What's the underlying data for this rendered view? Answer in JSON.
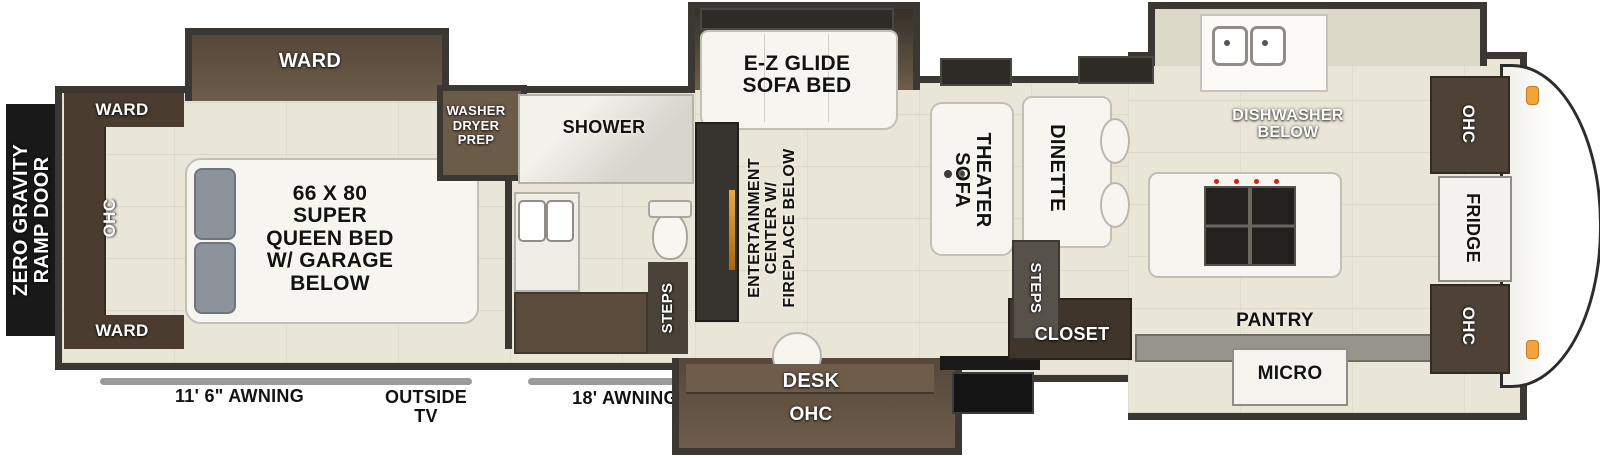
{
  "ramp_door": {
    "label": "ZERO GRAVITY RAMP DOOR"
  },
  "bedroom": {
    "slide_ward_label": "WARD",
    "corner_ward_label": "WARD",
    "bottom_ward_label": "WARD",
    "ohc_label": "OHC",
    "bed_label": "66 X 80 SUPER QUEEN BED W/ GARAGE BELOW"
  },
  "bath": {
    "washer_dryer_label": "WASHER DRYER PREP",
    "shower_label": "SHOWER",
    "steps_label": "STEPS"
  },
  "living": {
    "sofa_bed_label": "E-Z GLIDE SOFA BED",
    "entertainment_label": "ENTERTAINMENT CENTER W/ FIREPLACE BELOW",
    "theater_sofa_label": "THEATER SOFA",
    "dinette_label": "DINETTE",
    "desk_label": "DESK",
    "desk_ohc_label": "OHC",
    "steps_label": "STEPS",
    "closet_label": "CLOSET"
  },
  "kitchen": {
    "dishwasher_label": "DISHWASHER BELOW",
    "pantry_label": "PANTRY",
    "micro_label": "MICRO",
    "ohc_top_label": "OHC",
    "fridge_label": "FRIDGE",
    "ohc_bottom_label": "OHC"
  },
  "exterior": {
    "awning_left_label": "11' 6\" AWNING",
    "outside_tv_label": "OUTSIDE TV",
    "awning_right_label": "18' AWNING"
  },
  "colors": {
    "wall": "#3b3833",
    "floor": "#e9e6d8",
    "cabinet": "#55473a",
    "accent_orange": "#f2a33e"
  }
}
